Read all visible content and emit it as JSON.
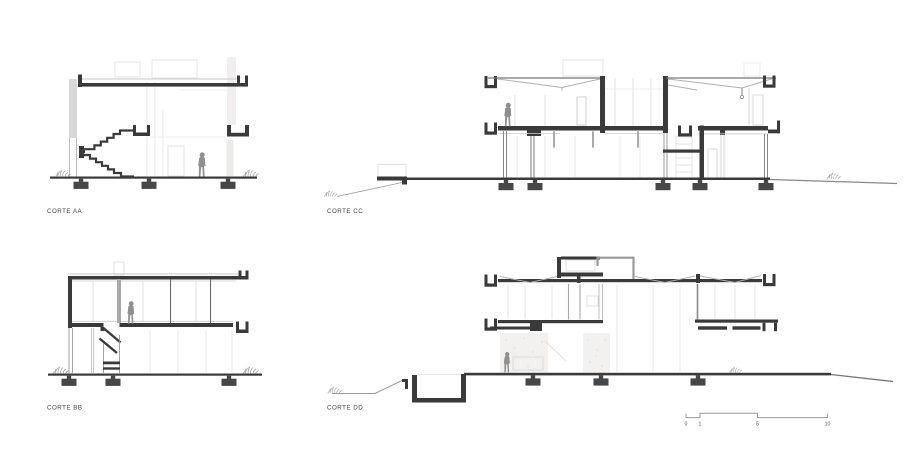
{
  "sheet": {
    "type": "architectural-section-drawings",
    "ink_color": "#3a3a3a",
    "faint_color": "#e4e4e4",
    "figure_color": "#8f8f8f",
    "background": "#ffffff",
    "sections": [
      {
        "id": "aa",
        "label": "CORTE AA"
      },
      {
        "id": "cc",
        "label": "CORTE CC"
      },
      {
        "id": "bb",
        "label": "CORTE BB"
      },
      {
        "id": "dd",
        "label": "CORTE DD"
      }
    ],
    "scalebar": {
      "ticks": [
        "0",
        "1",
        "5",
        "10"
      ]
    }
  }
}
